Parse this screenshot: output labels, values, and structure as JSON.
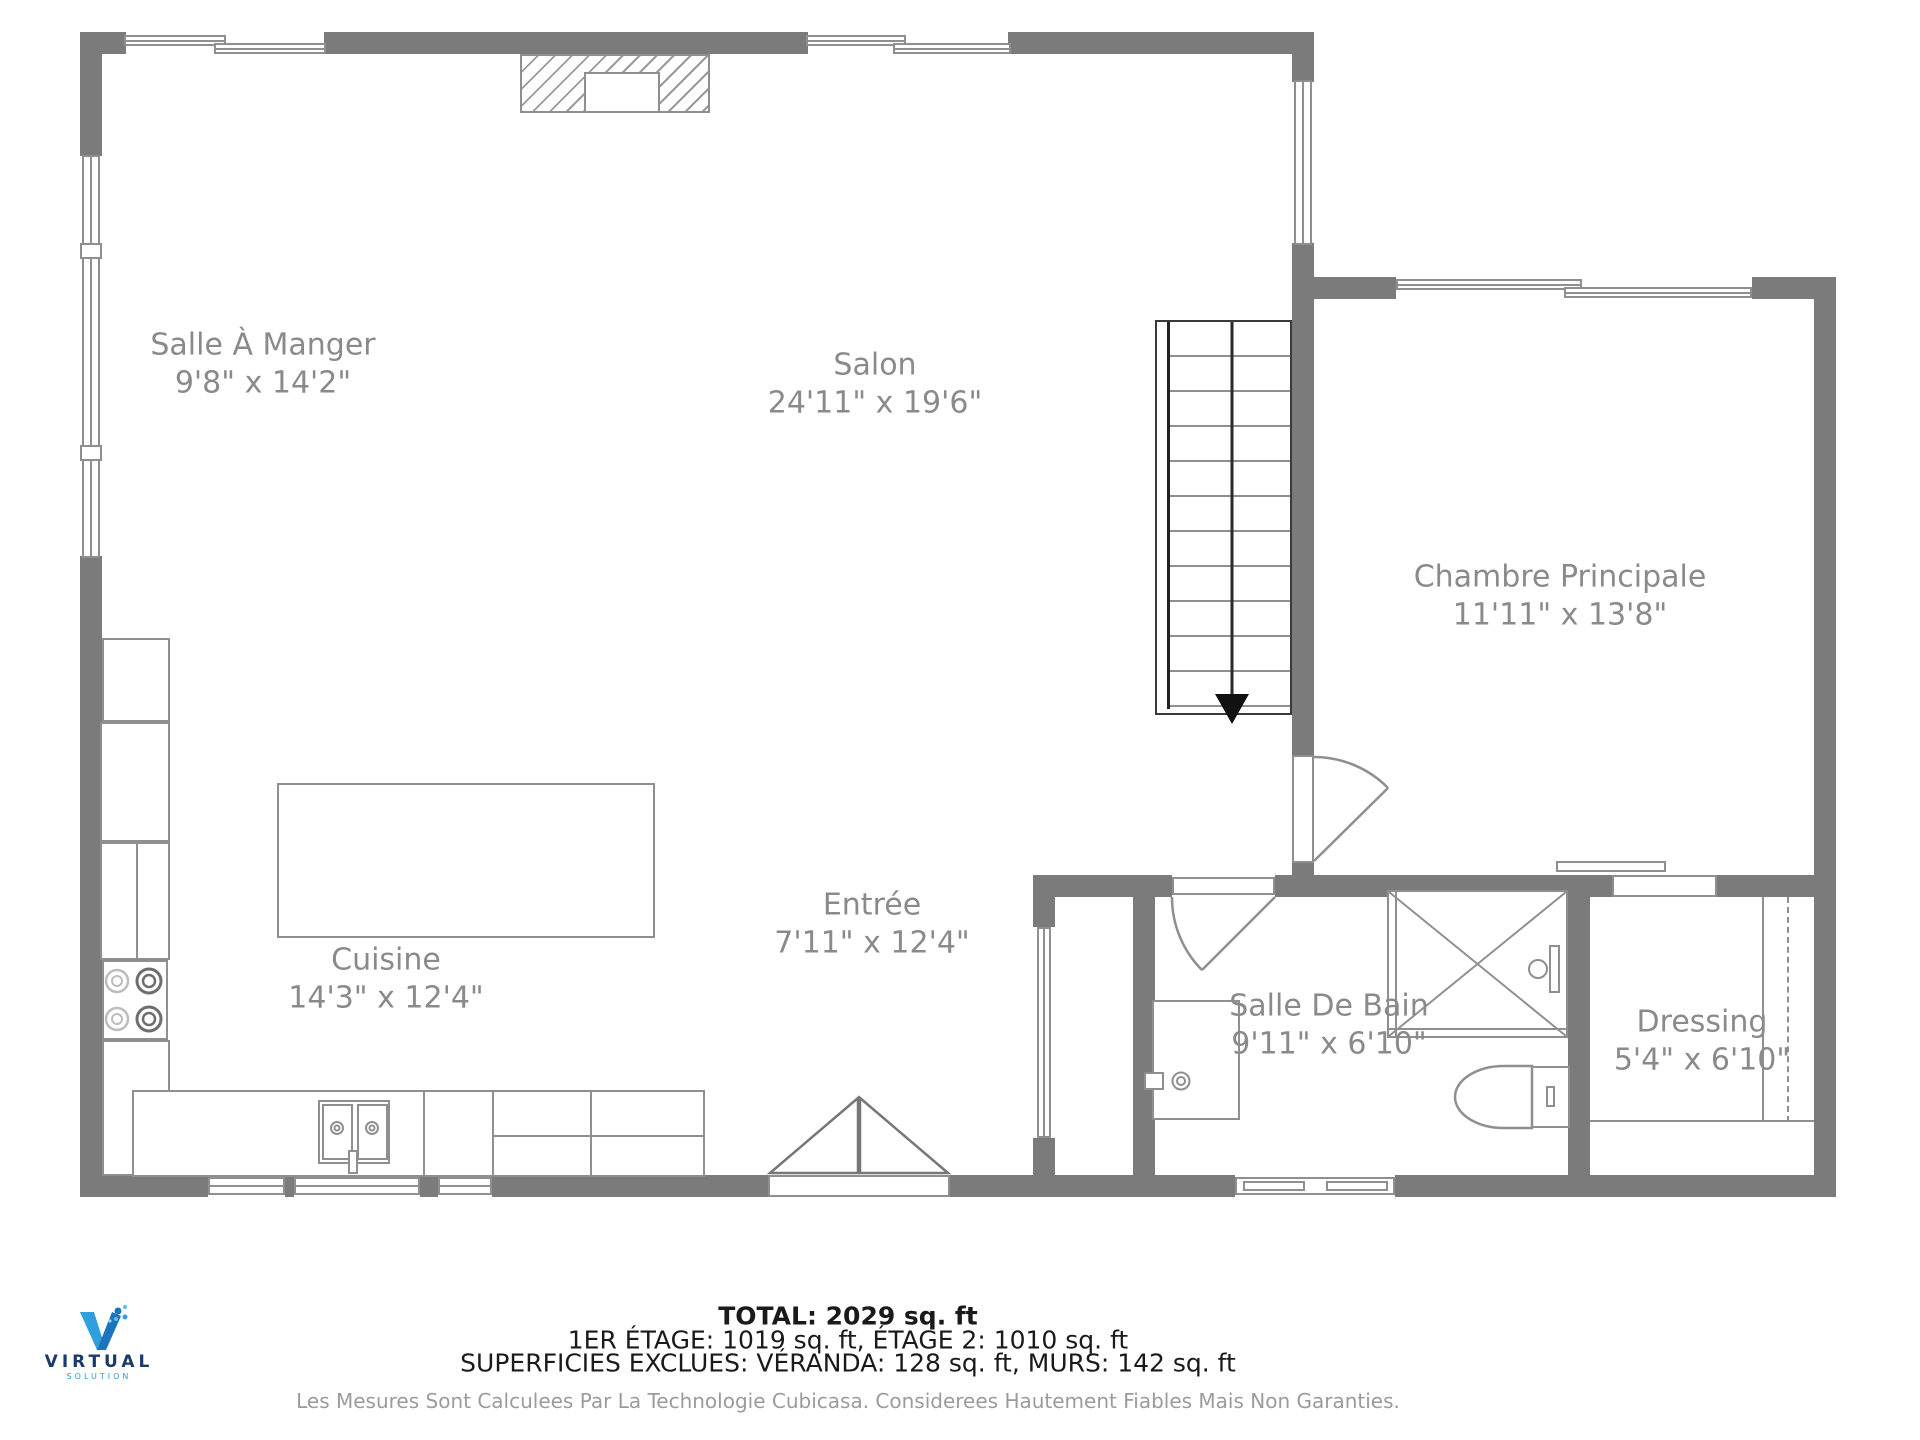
{
  "palette": {
    "wall": "#7b7b7b",
    "line": "#8f8f8f",
    "label": "#8a8a8a",
    "dark": "#2a2a2a",
    "footer": "#1a1a1a",
    "disclaimer": "#9b9b9b",
    "logo_navy": "#1b3a6b",
    "logo_blue": "#2a9fd8"
  },
  "rooms": [
    {
      "id": "salle-a-manger",
      "name": "Salle À Manger",
      "dims": "9'8\" x 14'2\""
    },
    {
      "id": "salon",
      "name": "Salon",
      "dims": "24'11\" x 19'6\""
    },
    {
      "id": "chambre-principale",
      "name": "Chambre Principale",
      "dims": "11'11\" x 13'8\""
    },
    {
      "id": "cuisine",
      "name": "Cuisine",
      "dims": "14'3\" x 12'4\""
    },
    {
      "id": "entree",
      "name": "Entrée",
      "dims": "7'11\" x 12'4\""
    },
    {
      "id": "salle-de-bain",
      "name": "Salle De Bain",
      "dims": "9'11\" x 6'10\""
    },
    {
      "id": "dressing",
      "name": "Dressing",
      "dims": "5'4\" x 6'10\""
    }
  ],
  "footer": {
    "total": "TOTAL: 2029 sq. ft",
    "floors": "1ER ÉTAGE: 1019 sq. ft, ÉTAGE 2: 1010 sq. ft",
    "exclusions": "SUPERFICIES EXCLUES: VÉRANDA: 128 sq. ft, MURS: 142 sq. ft",
    "disclaimer": "Les Mesures Sont Calculees Par La Technologie Cubicasa. Considerees Hautement Fiables Mais Non Garanties."
  },
  "logo": {
    "brand": "VIRTUAL",
    "tagline": "SOLUTION"
  }
}
